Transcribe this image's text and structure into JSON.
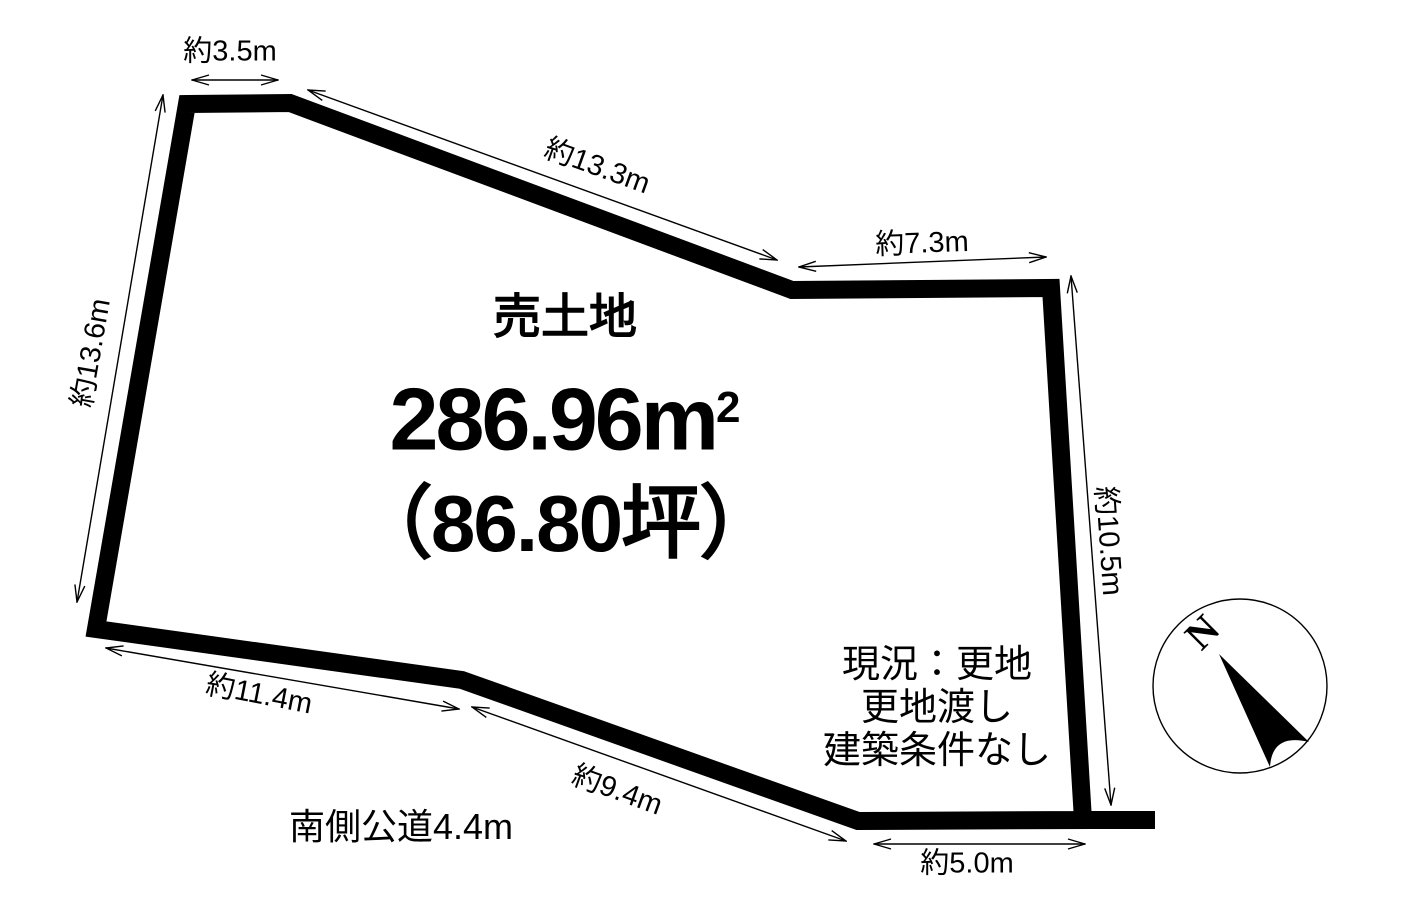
{
  "parcel": {
    "title": "売土地",
    "area_number": "286.96",
    "area_unit_base": "m",
    "area_unit_exponent": "2",
    "area_tsubo": "（86.80坪）",
    "status_line1": "現況：更地",
    "status_line2": "更地渡し",
    "status_line3": "建築条件なし"
  },
  "dimensions": {
    "top_edge": "約3.5m",
    "upper_diagonal_edge": "約13.3m",
    "top_right_edge": "約7.3m",
    "left_edge": "約13.6m",
    "right_edge": "約10.5m",
    "lower_left_edge": "約11.4m",
    "lower_diagonal_edge": "約9.4m",
    "bottom_edge": "約5.0m"
  },
  "road": {
    "label": "南側公道4.4m"
  },
  "compass": {
    "north_label": "N"
  },
  "colors": {
    "outline": "#000000",
    "background": "#ffffff",
    "text": "#000000"
  }
}
